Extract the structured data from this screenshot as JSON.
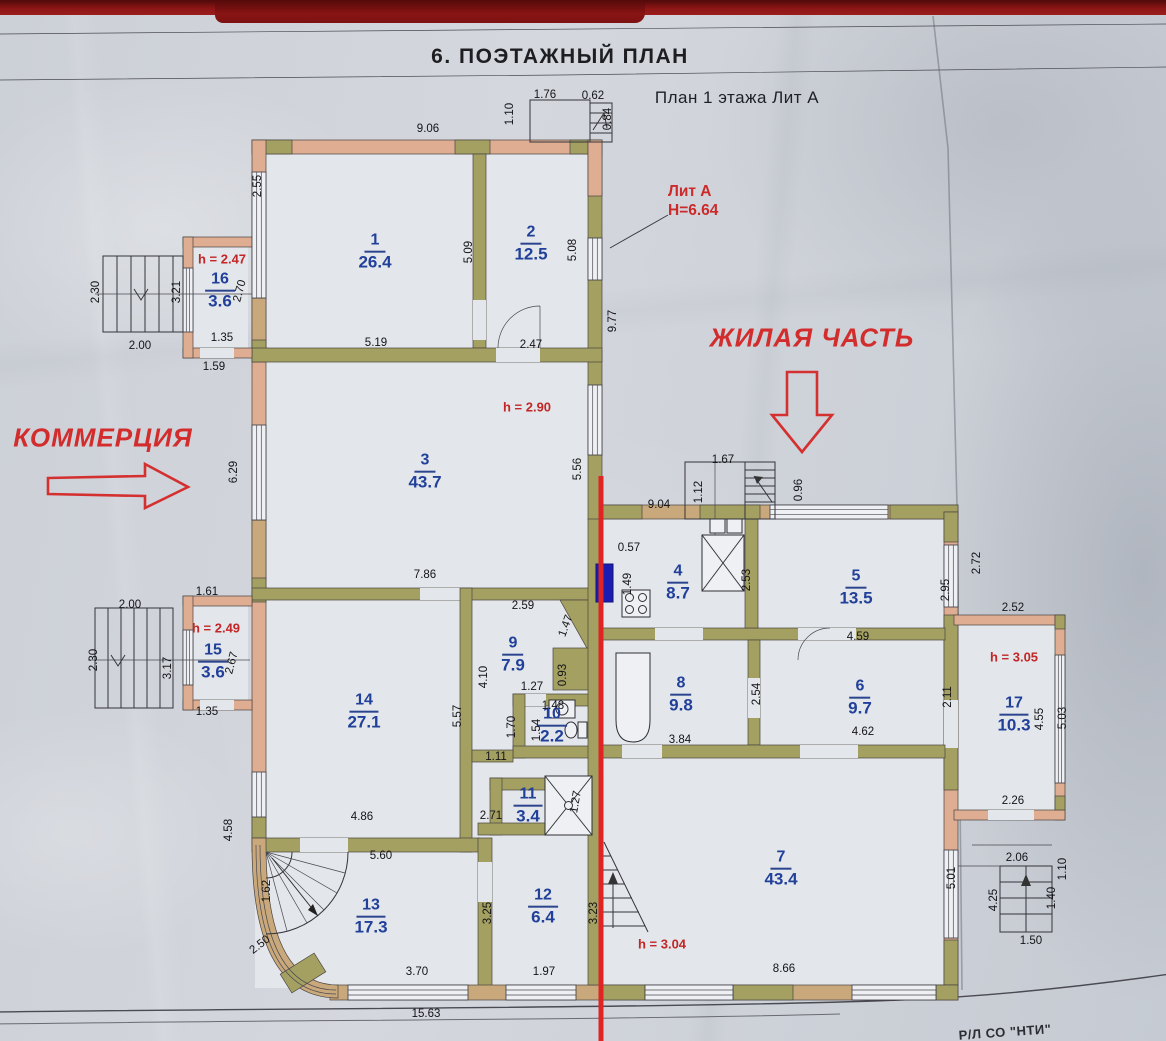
{
  "page": {
    "title": "6. ПОЭТАЖНЫЙ ПЛАН",
    "subtitle": "План 1 этажа Лит А",
    "footer": "Р/Л СО \"НТИ\""
  },
  "zones": {
    "commercial": "КОММЕРЦИЯ",
    "residential": "ЖИЛАЯ ЧАСТЬ"
  },
  "building": {
    "label": "Лит А",
    "height": "Н=6.64"
  },
  "colors": {
    "accent_red": "#d22c2c",
    "label_blue": "#21409a",
    "wall_olive": "#a3a061",
    "wall_pink": "#dfae92",
    "wall_tan": "#c9a87b",
    "divider_red": "#d43030",
    "marker_blue": "#1a1db0"
  },
  "rooms": [
    {
      "n": "1",
      "a": "26.4",
      "x": 375,
      "y": 252
    },
    {
      "n": "2",
      "a": "12.5",
      "x": 531,
      "y": 244
    },
    {
      "n": "3",
      "a": "43.7",
      "x": 425,
      "y": 472
    },
    {
      "n": "4",
      "a": "8.7",
      "x": 678,
      "y": 583
    },
    {
      "n": "5",
      "a": "13.5",
      "x": 856,
      "y": 588
    },
    {
      "n": "6",
      "a": "9.7",
      "x": 860,
      "y": 698
    },
    {
      "n": "7",
      "a": "43.4",
      "x": 781,
      "y": 869
    },
    {
      "n": "8",
      "a": "9.8",
      "x": 681,
      "y": 695
    },
    {
      "n": "9",
      "a": "7.9",
      "x": 513,
      "y": 655
    },
    {
      "n": "10",
      "a": "2.2",
      "x": 552,
      "y": 726
    },
    {
      "n": "11",
      "a": "3.4",
      "x": 528,
      "y": 806
    },
    {
      "n": "12",
      "a": "6.4",
      "x": 543,
      "y": 907
    },
    {
      "n": "13",
      "a": "17.3",
      "x": 371,
      "y": 917
    },
    {
      "n": "14",
      "a": "27.1",
      "x": 364,
      "y": 712
    },
    {
      "n": "15",
      "a": "3.6",
      "x": 213,
      "y": 662
    },
    {
      "n": "16",
      "a": "3.6",
      "x": 220,
      "y": 291
    },
    {
      "n": "17",
      "a": "10.3",
      "x": 1014,
      "y": 715
    }
  ],
  "heights": [
    {
      "t": "h = 2.47",
      "x": 222,
      "y": 259
    },
    {
      "t": "h = 2.90",
      "x": 527,
      "y": 407
    },
    {
      "t": "h = 2.49",
      "x": 216,
      "y": 628
    },
    {
      "t": "h = 3.05",
      "x": 1014,
      "y": 657
    },
    {
      "t": "h = 3.04",
      "x": 662,
      "y": 944
    }
  ],
  "dims": [
    {
      "t": "9.06",
      "x": 428,
      "y": 129
    },
    {
      "t": "1.76",
      "x": 545,
      "y": 95
    },
    {
      "t": "0.62",
      "x": 593,
      "y": 96
    },
    {
      "t": "1.10",
      "x": 510,
      "y": 114,
      "r": -90
    },
    {
      "t": "0.84",
      "x": 608,
      "y": 119,
      "r": -90
    },
    {
      "t": "2.55",
      "x": 258,
      "y": 186,
      "r": -90
    },
    {
      "t": "5.09",
      "x": 469,
      "y": 252,
      "r": -90
    },
    {
      "t": "5.08",
      "x": 573,
      "y": 250,
      "r": -90
    },
    {
      "t": "9.77",
      "x": 613,
      "y": 321,
      "r": -90
    },
    {
      "t": "2.30",
      "x": 96,
      "y": 292,
      "r": -90
    },
    {
      "t": "3.21",
      "x": 177,
      "y": 292,
      "r": -90
    },
    {
      "t": "2.70",
      "x": 240,
      "y": 291,
      "r": -75
    },
    {
      "t": "2.00",
      "x": 140,
      "y": 346
    },
    {
      "t": "1.35",
      "x": 222,
      "y": 338
    },
    {
      "t": "1.59",
      "x": 214,
      "y": 367
    },
    {
      "t": "5.19",
      "x": 376,
      "y": 343
    },
    {
      "t": "2.47",
      "x": 531,
      "y": 345
    },
    {
      "t": "6.29",
      "x": 234,
      "y": 472,
      "r": -90
    },
    {
      "t": "5.56",
      "x": 578,
      "y": 469,
      "r": -90
    },
    {
      "t": "1.67",
      "x": 723,
      "y": 460
    },
    {
      "t": "1.12",
      "x": 699,
      "y": 492,
      "r": -90
    },
    {
      "t": "0.96",
      "x": 799,
      "y": 490,
      "r": -90
    },
    {
      "t": "9.04",
      "x": 659,
      "y": 505
    },
    {
      "t": "0.57",
      "x": 629,
      "y": 548
    },
    {
      "t": "1.49",
      "x": 628,
      "y": 584,
      "r": -90
    },
    {
      "t": "2.53",
      "x": 747,
      "y": 580,
      "r": -90
    },
    {
      "t": "2.72",
      "x": 977,
      "y": 563,
      "r": -90
    },
    {
      "t": "2.95",
      "x": 946,
      "y": 590,
      "r": -90
    },
    {
      "t": "2.52",
      "x": 1013,
      "y": 608
    },
    {
      "t": "7.86",
      "x": 425,
      "y": 575
    },
    {
      "t": "2.59",
      "x": 523,
      "y": 606
    },
    {
      "t": "1.47",
      "x": 566,
      "y": 626,
      "r": -70
    },
    {
      "t": "1.61",
      "x": 207,
      "y": 592
    },
    {
      "t": "2.00",
      "x": 130,
      "y": 605
    },
    {
      "t": "2.30",
      "x": 94,
      "y": 660,
      "r": -90
    },
    {
      "t": "3.17",
      "x": 168,
      "y": 668,
      "r": -90
    },
    {
      "t": "2.67",
      "x": 232,
      "y": 663,
      "r": -75
    },
    {
      "t": "1.35",
      "x": 207,
      "y": 712
    },
    {
      "t": "4.59",
      "x": 858,
      "y": 637
    },
    {
      "t": "4.10",
      "x": 484,
      "y": 677,
      "r": -90
    },
    {
      "t": "1.27",
      "x": 532,
      "y": 687
    },
    {
      "t": "0.93",
      "x": 563,
      "y": 675,
      "r": -90
    },
    {
      "t": "1.48",
      "x": 553,
      "y": 706
    },
    {
      "t": "1.54",
      "x": 537,
      "y": 730,
      "r": -90
    },
    {
      "t": "1.70",
      "x": 512,
      "y": 727,
      "r": -90
    },
    {
      "t": "5.57",
      "x": 458,
      "y": 716,
      "r": -90
    },
    {
      "t": "2.54",
      "x": 757,
      "y": 694,
      "r": -90
    },
    {
      "t": "3.84",
      "x": 680,
      "y": 740
    },
    {
      "t": "4.62",
      "x": 863,
      "y": 732
    },
    {
      "t": "2.11",
      "x": 948,
      "y": 697,
      "r": -90
    },
    {
      "t": "4.55",
      "x": 1040,
      "y": 719,
      "r": -90
    },
    {
      "t": "5.03",
      "x": 1063,
      "y": 718,
      "r": -90
    },
    {
      "t": "2.26",
      "x": 1013,
      "y": 801
    },
    {
      "t": "1.11",
      "x": 496,
      "y": 757
    },
    {
      "t": "2.71",
      "x": 491,
      "y": 816
    },
    {
      "t": "1.27",
      "x": 576,
      "y": 802,
      "r": -80
    },
    {
      "t": "4.86",
      "x": 362,
      "y": 817
    },
    {
      "t": "5.60",
      "x": 381,
      "y": 856
    },
    {
      "t": "1.62",
      "x": 267,
      "y": 891,
      "r": -90
    },
    {
      "t": "4.58",
      "x": 229,
      "y": 830,
      "r": -90
    },
    {
      "t": "2.50",
      "x": 260,
      "y": 945,
      "r": -38
    },
    {
      "t": "3.25",
      "x": 488,
      "y": 913,
      "r": -90
    },
    {
      "t": "3.23",
      "x": 594,
      "y": 913,
      "r": -90
    },
    {
      "t": "3.70",
      "x": 417,
      "y": 972
    },
    {
      "t": "1.97",
      "x": 544,
      "y": 972
    },
    {
      "t": "8.66",
      "x": 784,
      "y": 969
    },
    {
      "t": "5.01",
      "x": 952,
      "y": 878,
      "r": -90
    },
    {
      "t": "2.06",
      "x": 1017,
      "y": 858
    },
    {
      "t": "1.10",
      "x": 1063,
      "y": 869,
      "r": -90
    },
    {
      "t": "1.40",
      "x": 1052,
      "y": 898,
      "r": -90
    },
    {
      "t": "4.25",
      "x": 994,
      "y": 900,
      "r": -90
    },
    {
      "t": "1.50",
      "x": 1031,
      "y": 941
    },
    {
      "t": "15.63",
      "x": 426,
      "y": 1014
    }
  ]
}
